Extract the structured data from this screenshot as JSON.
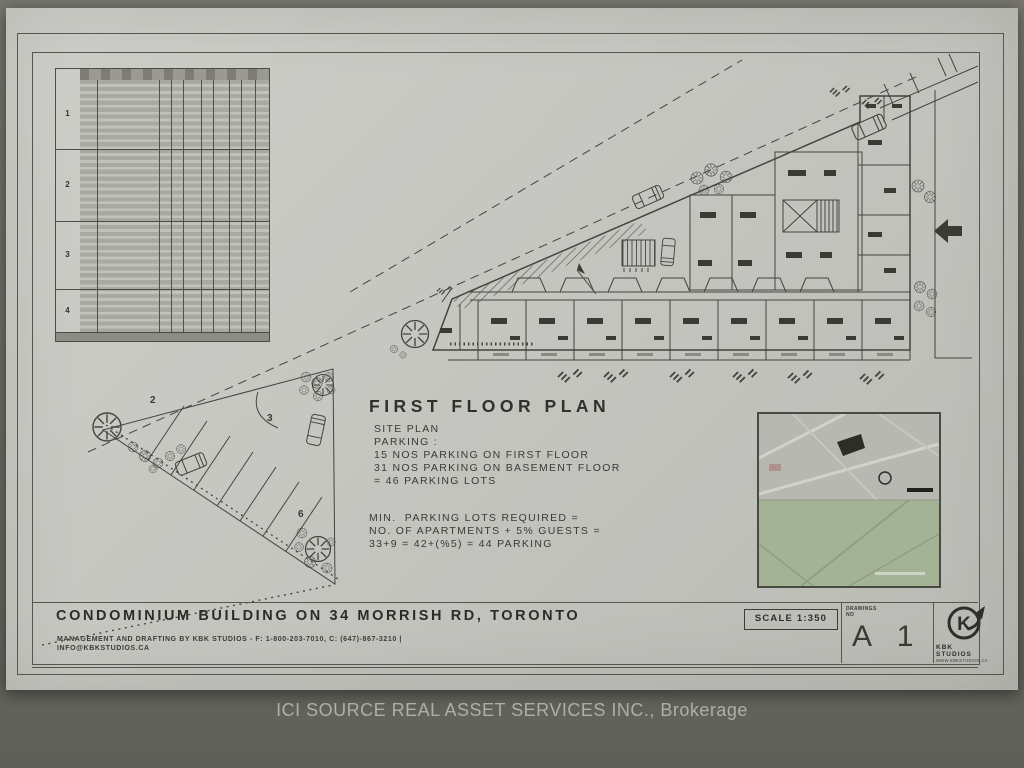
{
  "watermark": "ICI SOURCE REAL ASSET SERVICES INC., Brokerage",
  "plan": {
    "title": "FIRST FLOOR PLAN",
    "site_notes": [
      "SITE PLAN",
      "PARKING :",
      "15 NOS PARKING ON FIRST FLOOR",
      "31 NOS PARKING ON BASEMENT FLOOR",
      "= 46 PARKING LOTS"
    ],
    "parking_calc": [
      "MIN.  PARKING LOTS REQUIRED =",
      "NO. OF APARTMENTS + 5% GUESTS =",
      "33+9 = 42+(%5) = 44 PARKING"
    ],
    "area_labels": {
      "label_2": "2",
      "label_3": "3",
      "label_6": "6"
    }
  },
  "schedule_table": {
    "floor_labels": [
      "1",
      "2",
      "3",
      "4"
    ]
  },
  "title_block": {
    "project_title": "CONDOMINIUM BUILDING ON 34 MORRISH RD, TORONTO",
    "credits_line1": "MANAGEMENT AND DRAFTING BY KBK STUDIOS - F: 1-800-203-7010, C: (647)-867-3210 |",
    "credits_line2": "INFO@KBKSTUDIOS.CA",
    "scale": "SCALE 1:350",
    "drawing_no_label_1": "DRAWINGS",
    "drawing_no_label_2": "NO",
    "drawing_no": "A 1",
    "logo_letter": "K",
    "studio_name_line1": "KBK",
    "studio_name_line2": "STUDIOS",
    "studio_url": "WWW.KBKSTUDIOS.CA"
  },
  "colors": {
    "paper": "#c6c6c1",
    "backdrop": "#6a6a61",
    "ink": "#3c3c36",
    "map_green": "#a4b295"
  }
}
